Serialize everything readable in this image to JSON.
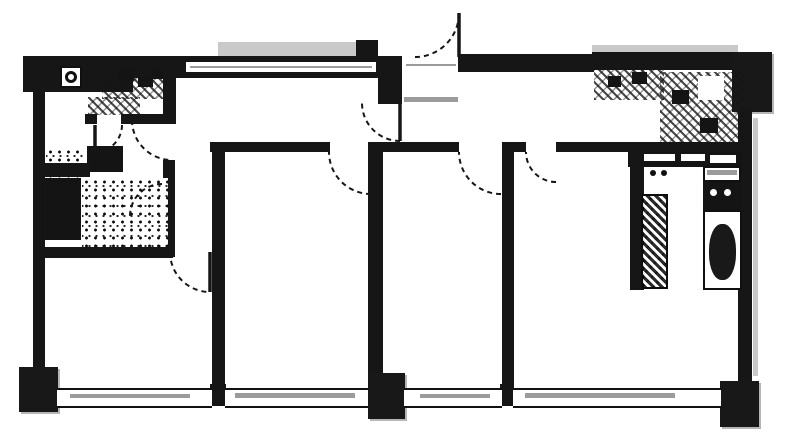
{
  "meta": {
    "width": 787,
    "height": 447,
    "colors": {
      "ink": "#1a1a1a",
      "scan_gray": "#9a9a9a",
      "background": "#ffffff"
    }
  },
  "plan": {
    "rects": [
      {
        "name": "pillar-top-left-band",
        "kind": "wall",
        "x": 23,
        "y": 56,
        "w": 110,
        "h": 36
      },
      {
        "name": "scan-smudge-top-step",
        "kind": "lightgray",
        "x": 218,
        "y": 42,
        "w": 158,
        "h": 14
      },
      {
        "name": "wall-top-notch",
        "kind": "wall",
        "x": 356,
        "y": 40,
        "w": 22,
        "h": 18
      },
      {
        "name": "wall-top",
        "kind": "wall",
        "x": 45,
        "y": 56,
        "w": 340,
        "h": 22
      },
      {
        "name": "window-top-slot",
        "kind": "slot",
        "x": 186,
        "y": 62,
        "w": 190,
        "h": 10
      },
      {
        "name": "window-top-slot-line",
        "kind": "gray",
        "x": 190,
        "y": 66,
        "w": 182,
        "h": 2
      },
      {
        "name": "wall-entry-stub",
        "kind": "wall",
        "x": 378,
        "y": 56,
        "w": 24,
        "h": 48
      },
      {
        "name": "entry-threshold",
        "kind": "slot",
        "x": 404,
        "y": 59,
        "w": 54,
        "h": 12
      },
      {
        "name": "entry-threshold-line",
        "kind": "gray",
        "x": 406,
        "y": 64,
        "w": 50,
        "h": 2
      },
      {
        "name": "wall-top-right-of-entry",
        "kind": "wall",
        "x": 458,
        "y": 54,
        "w": 136,
        "h": 18
      },
      {
        "name": "scan-smudge-kitchen-top",
        "kind": "lightgray",
        "x": 592,
        "y": 45,
        "w": 146,
        "h": 7
      },
      {
        "name": "wall-top-kitchen",
        "kind": "wall",
        "x": 592,
        "y": 52,
        "w": 146,
        "h": 18
      },
      {
        "name": "pillar-top-right",
        "kind": "pillar",
        "x": 732,
        "y": 52,
        "w": 40,
        "h": 60
      },
      {
        "name": "wall-left",
        "kind": "wall",
        "x": 33,
        "y": 90,
        "w": 12,
        "h": 282
      },
      {
        "name": "wall-right",
        "kind": "wall",
        "x": 738,
        "y": 110,
        "w": 14,
        "h": 276
      },
      {
        "name": "scan-smudge-right-edge",
        "kind": "lightgray",
        "x": 753,
        "y": 118,
        "w": 5,
        "h": 258
      },
      {
        "name": "fan-icon-box",
        "kind": "whitebox",
        "x": 60,
        "y": 66,
        "w": 22,
        "h": 22
      },
      {
        "name": "fan-icon",
        "kind": "ring",
        "x": 65,
        "y": 71,
        "w": 12,
        "h": 12
      },
      {
        "name": "vanity-counter",
        "kind": "hatch",
        "x": 102,
        "y": 67,
        "w": 64,
        "h": 32
      },
      {
        "name": "vanity-sink",
        "kind": "solid",
        "x": 118,
        "y": 70,
        "w": 16,
        "h": 11
      },
      {
        "name": "vanity-fitting-1",
        "kind": "solid",
        "x": 138,
        "y": 77,
        "w": 15,
        "h": 10
      },
      {
        "name": "vanity-fitting-2",
        "kind": "solid",
        "x": 152,
        "y": 70,
        "w": 12,
        "h": 9
      },
      {
        "name": "vanity-apron",
        "kind": "hatch",
        "x": 88,
        "y": 97,
        "w": 52,
        "h": 18
      },
      {
        "name": "wall-wc-room-right",
        "kind": "wall",
        "x": 163,
        "y": 62,
        "w": 13,
        "h": 58
      },
      {
        "name": "wall-wc-bottom-left",
        "kind": "wall",
        "x": 85,
        "y": 114,
        "w": 12,
        "h": 10
      },
      {
        "name": "wall-wc-bottom-right",
        "kind": "wall",
        "x": 121,
        "y": 114,
        "w": 55,
        "h": 10
      },
      {
        "name": "wall-washroom-right",
        "kind": "wall",
        "x": 163,
        "y": 160,
        "w": 12,
        "h": 97
      },
      {
        "name": "washer-unit",
        "kind": "solid",
        "x": 87,
        "y": 146,
        "w": 36,
        "h": 26
      },
      {
        "name": "washroom-floor-tile",
        "kind": "speckle",
        "x": 46,
        "y": 148,
        "w": 38,
        "h": 34
      },
      {
        "name": "wall-bath-divider",
        "kind": "wall",
        "x": 35,
        "y": 163,
        "w": 55,
        "h": 14
      },
      {
        "name": "bathtub",
        "kind": "solid",
        "x": 41,
        "y": 178,
        "w": 40,
        "h": 62
      },
      {
        "name": "bathroom-floor-tile",
        "kind": "speckle",
        "x": 82,
        "y": 178,
        "w": 86,
        "h": 72
      },
      {
        "name": "wall-bathroom-bottom",
        "kind": "wall",
        "x": 33,
        "y": 247,
        "w": 140,
        "h": 11
      },
      {
        "name": "wall-hallway-seg-1",
        "kind": "wall",
        "x": 210,
        "y": 142,
        "w": 120,
        "h": 10
      },
      {
        "name": "wall-hallway-seg-2",
        "kind": "wall",
        "x": 372,
        "y": 142,
        "w": 87,
        "h": 10
      },
      {
        "name": "wall-hallway-seg-3",
        "kind": "wall",
        "x": 502,
        "y": 142,
        "w": 24,
        "h": 10
      },
      {
        "name": "wall-hallway-seg-4",
        "kind": "wall",
        "x": 556,
        "y": 142,
        "w": 184,
        "h": 10
      },
      {
        "name": "wall-divider-left",
        "kind": "wall",
        "x": 212,
        "y": 142,
        "w": 13,
        "h": 246
      },
      {
        "name": "wall-divider-left-stub",
        "kind": "wall",
        "x": 210,
        "y": 384,
        "w": 16,
        "h": 22
      },
      {
        "name": "wall-divider-center",
        "kind": "wall",
        "x": 368,
        "y": 142,
        "w": 15,
        "h": 231
      },
      {
        "name": "wall-divider-right",
        "kind": "wall",
        "x": 502,
        "y": 142,
        "w": 12,
        "h": 246
      },
      {
        "name": "wall-divider-right-stub",
        "kind": "wall",
        "x": 500,
        "y": 384,
        "w": 14,
        "h": 22
      },
      {
        "name": "kitchen-counter-top",
        "kind": "hatch",
        "x": 594,
        "y": 68,
        "w": 70,
        "h": 32
      },
      {
        "name": "kitchen-counter-corner",
        "kind": "hatch",
        "x": 660,
        "y": 72,
        "w": 86,
        "h": 74
      },
      {
        "name": "kitchen-sink",
        "kind": "solid",
        "x": 608,
        "y": 76,
        "w": 13,
        "h": 11
      },
      {
        "name": "kitchen-burner-1",
        "kind": "solid",
        "x": 632,
        "y": 72,
        "w": 15,
        "h": 12
      },
      {
        "name": "kitchen-burner-2",
        "kind": "solid",
        "x": 672,
        "y": 90,
        "w": 17,
        "h": 14
      },
      {
        "name": "kitchen-fitting",
        "kind": "solid",
        "x": 700,
        "y": 118,
        "w": 18,
        "h": 15
      },
      {
        "name": "kitchen-counter-gap",
        "kind": "slot",
        "x": 698,
        "y": 76,
        "w": 26,
        "h": 24
      },
      {
        "name": "kitchen-cabinet-front",
        "kind": "solid",
        "x": 628,
        "y": 152,
        "w": 114,
        "h": 15
      },
      {
        "name": "cabinet-slot-1",
        "kind": "slot",
        "x": 643,
        "y": 154,
        "w": 32,
        "h": 7
      },
      {
        "name": "cabinet-slot-2",
        "kind": "slot",
        "x": 681,
        "y": 154,
        "w": 24,
        "h": 7
      },
      {
        "name": "cabinet-slot-3",
        "kind": "slot",
        "x": 710,
        "y": 155,
        "w": 26,
        "h": 8
      },
      {
        "name": "wall-kitchen-nook",
        "kind": "wall",
        "x": 630,
        "y": 152,
        "w": 14,
        "h": 138
      },
      {
        "name": "counter-strip",
        "kind": "hatchdark",
        "x": 641,
        "y": 194,
        "w": 27,
        "h": 95
      },
      {
        "name": "counter-knob-1",
        "kind": "dot",
        "x": 650,
        "y": 170,
        "w": 6,
        "h": 6
      },
      {
        "name": "counter-knob-2",
        "kind": "dot",
        "x": 661,
        "y": 170,
        "w": 6,
        "h": 6
      },
      {
        "name": "utility-shelf",
        "kind": "whitebox",
        "x": 703,
        "y": 166,
        "w": 38,
        "h": 16
      },
      {
        "name": "utility-shelf-line",
        "kind": "gray",
        "x": 707,
        "y": 170,
        "w": 30,
        "h": 5
      },
      {
        "name": "utility-tank",
        "kind": "solid",
        "x": 703,
        "y": 182,
        "w": 38,
        "h": 28
      },
      {
        "name": "utility-tank-dot-1",
        "kind": "whitedot",
        "x": 710,
        "y": 189,
        "w": 7,
        "h": 7
      },
      {
        "name": "utility-tank-dot-2",
        "kind": "whitedot",
        "x": 724,
        "y": 189,
        "w": 7,
        "h": 7
      },
      {
        "name": "utility-stall",
        "kind": "whitebox",
        "x": 703,
        "y": 210,
        "w": 39,
        "h": 80
      },
      {
        "name": "toilet-bowl",
        "kind": "solidround",
        "x": 709,
        "y": 224,
        "w": 27,
        "h": 56
      },
      {
        "name": "pillar-bottom-left",
        "kind": "pillar",
        "x": 19,
        "y": 367,
        "w": 39,
        "h": 45
      },
      {
        "name": "pillar-bottom-center",
        "kind": "pillar",
        "x": 368,
        "y": 373,
        "w": 37,
        "h": 46
      },
      {
        "name": "pillar-bottom-right",
        "kind": "pillar",
        "x": 720,
        "y": 381,
        "w": 39,
        "h": 46
      },
      {
        "name": "balcony-window-1",
        "kind": "window",
        "x": 57,
        "y": 388,
        "w": 155,
        "h": 16
      },
      {
        "name": "balcony-window-2",
        "kind": "window",
        "x": 225,
        "y": 388,
        "w": 143,
        "h": 16
      },
      {
        "name": "balcony-window-3",
        "kind": "window",
        "x": 404,
        "y": 388,
        "w": 98,
        "h": 16
      },
      {
        "name": "balcony-window-4",
        "kind": "window",
        "x": 513,
        "y": 388,
        "w": 208,
        "h": 16
      },
      {
        "name": "window-smudge-1",
        "kind": "gray",
        "x": 70,
        "y": 394,
        "w": 120,
        "h": 4
      },
      {
        "name": "window-smudge-2",
        "kind": "gray",
        "x": 235,
        "y": 393,
        "w": 120,
        "h": 5
      },
      {
        "name": "window-smudge-3",
        "kind": "gray",
        "x": 420,
        "y": 394,
        "w": 70,
        "h": 4
      },
      {
        "name": "window-smudge-4",
        "kind": "gray",
        "x": 525,
        "y": 393,
        "w": 150,
        "h": 5
      },
      {
        "name": "genkan-step-line",
        "kind": "gray",
        "x": 404,
        "y": 97,
        "w": 54,
        "h": 5
      }
    ],
    "doors": [
      {
        "name": "entry-door-swing",
        "cx": 459,
        "cy": 57,
        "r": 44,
        "a1": 180,
        "a2": 270,
        "sweep": 0
      },
      {
        "name": "genkan-door-swing",
        "cx": 400,
        "cy": 103,
        "r": 38,
        "a1": 90,
        "a2": 180,
        "sweep": 1
      },
      {
        "name": "room1-door-swing",
        "cx": 371,
        "cy": 152,
        "r": 42,
        "a1": 90,
        "a2": 180,
        "sweep": 1
      },
      {
        "name": "room2-door-swing",
        "cx": 501,
        "cy": 152,
        "r": 42,
        "a1": 90,
        "a2": 180,
        "sweep": 1
      },
      {
        "name": "ldk-door-swing",
        "cx": 556,
        "cy": 152,
        "r": 30,
        "a1": 90,
        "a2": 180,
        "sweep": 1
      },
      {
        "name": "wc-door-swing",
        "cx": 95,
        "cy": 125,
        "r": 27,
        "a1": 0,
        "a2": 90,
        "sweep": 1
      },
      {
        "name": "washroom-door-swing",
        "cx": 172,
        "cy": 120,
        "r": 40,
        "a1": 180,
        "a2": 90,
        "sweep": 0
      },
      {
        "name": "bathroom-door-swing",
        "cx": 162,
        "cy": 216,
        "r": 32,
        "a1": 270,
        "a2": 180,
        "sweep": 0
      },
      {
        "name": "bedroom-left-door-swing",
        "cx": 210,
        "cy": 252,
        "r": 40,
        "a1": 180,
        "a2": 90,
        "sweep": 0
      }
    ],
    "leaves": [
      {
        "name": "entry-door-leaf",
        "x1": 459,
        "y1": 13,
        "x2": 459,
        "y2": 57
      },
      {
        "name": "genkan-door-leaf",
        "x1": 400,
        "y1": 103,
        "x2": 400,
        "y2": 141
      },
      {
        "name": "wc-door-leaf",
        "x1": 95,
        "y1": 125,
        "x2": 95,
        "y2": 152
      },
      {
        "name": "washroom-door-leaf",
        "x1": 134,
        "y1": 120,
        "x2": 172,
        "y2": 120
      },
      {
        "name": "bedroom-left-door-leaf",
        "x1": 210,
        "y1": 252,
        "x2": 210,
        "y2": 292
      }
    ]
  }
}
